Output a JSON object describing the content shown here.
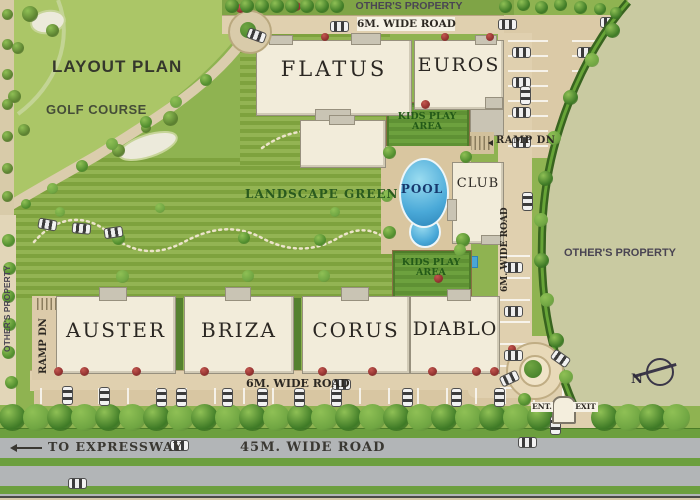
{
  "title": "LAYOUT PLAN",
  "areas": {
    "golf_course": "GOLF COURSE",
    "landscape_green": "LANDSCAPE GREEN",
    "kids_play_area": "KIDS PLAY AREA",
    "pool": "POOL",
    "club": "CLUB"
  },
  "buildings": {
    "flatus": "FLATUS",
    "euros": "EUROS",
    "auster": "AUSTER",
    "briza": "BRIZA",
    "corus": "CORUS",
    "diablo": "DIABLO"
  },
  "properties": {
    "top": "OTHER'S PROPERTY",
    "right": "OTHER'S PROPERTY",
    "left": "OTHER'S PROPERTY"
  },
  "roads": {
    "top_6m": "6M. WIDE ROAD",
    "bottom_6m": "6M. WIDE ROAD",
    "side_6m": "6M. WIDE ROAD",
    "main_45m": "45M. WIDE ROAD",
    "to_expressway": "TO EXPRESSWAY"
  },
  "ramps": {
    "top": "RAMP DN",
    "left": "RAMP DN"
  },
  "gate": {
    "entry": "ENT.",
    "exit": "EXIT"
  },
  "compass": {
    "north": "N"
  },
  "colors": {
    "golf_green": "#abc667",
    "lawn_green": "#7ea23e",
    "olive_property": "#c9caa1",
    "road_tan": "#e0d0af",
    "highway_gray": "#b2b5b7",
    "building_cream": "#f2ecda",
    "pool_blue": "#3f9fd0",
    "hedge_green": "#3e7a26",
    "red_shrub": "#8e2f2e"
  }
}
